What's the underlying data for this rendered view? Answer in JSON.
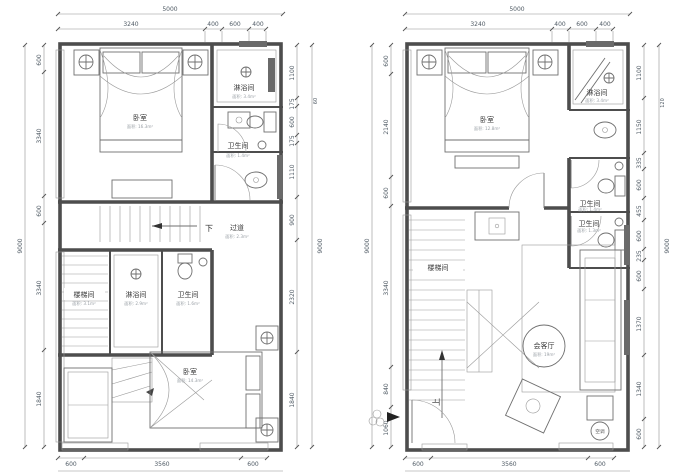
{
  "canvas": {
    "background": "#ffffff",
    "line_color": "#4d4d4d",
    "dim_text_color": "#4f5a64"
  },
  "plans": [
    {
      "name": "upper-floor-plan",
      "top_total": "5000",
      "top_segments": [
        "3240",
        "400",
        "600",
        "400"
      ],
      "left_total": "9000",
      "left_segments": [
        "600",
        "3340",
        "600",
        "3340",
        "1840"
      ],
      "right_total": "9000",
      "right_mark": "60",
      "right_segments": [
        "1100",
        "175",
        "600",
        "175",
        "1110",
        "900",
        "2320",
        "1840"
      ],
      "bottom_segments": [
        "600",
        "3560",
        "600"
      ],
      "rooms": {
        "bedroom_top": {
          "label": "卧室",
          "area": "面积: 16.3m²"
        },
        "shower_top": {
          "label": "淋浴间",
          "area": "面积: 3.4m²"
        },
        "wc_top": {
          "label": "卫生间",
          "area": "面积: 1.4m²"
        },
        "corridor": {
          "label": "过道",
          "area": "面积: 2.3m²"
        },
        "stair": {
          "label": "楼梯间",
          "area": "面积: 3.1m²"
        },
        "shower_mid": {
          "label": "淋浴间",
          "area": "面积: 2.9m²"
        },
        "wc_mid": {
          "label": "卫生间",
          "area": "面积: 1.6m²"
        },
        "bedroom_bottom": {
          "label": "卧室",
          "area": "面积: 14.3m²"
        }
      },
      "annotations": {
        "down": "下"
      }
    },
    {
      "name": "lower-floor-plan",
      "top_total": "5000",
      "top_segments": [
        "3240",
        "400",
        "600",
        "400"
      ],
      "left_total": "9000",
      "left_segments": [
        "600",
        "2140",
        "600",
        "3340",
        "840",
        "1060"
      ],
      "right_total": "9000",
      "right_mark": "120",
      "right_segments": [
        "1100",
        "1150",
        "335",
        "600",
        "455",
        "600",
        "235",
        "600",
        "1370",
        "1340",
        "600"
      ],
      "bottom_segments": [
        "600",
        "3560",
        "600"
      ],
      "rooms": {
        "bedroom": {
          "label": "卧室",
          "area": "面积: 12.8m²"
        },
        "shower": {
          "label": "淋浴间",
          "area": "面积: 3.4m²"
        },
        "wc1": {
          "label": "卫生间",
          "area": "面积: 1.4m²"
        },
        "wc2": {
          "label": "卫生间",
          "area": "面积: 1.3m²"
        },
        "stair": {
          "label": "楼梯间"
        },
        "living": {
          "label": "会客厅",
          "area": "面积: 19m²"
        }
      },
      "annotations": {
        "up": "上",
        "ac": "空调"
      }
    }
  ]
}
